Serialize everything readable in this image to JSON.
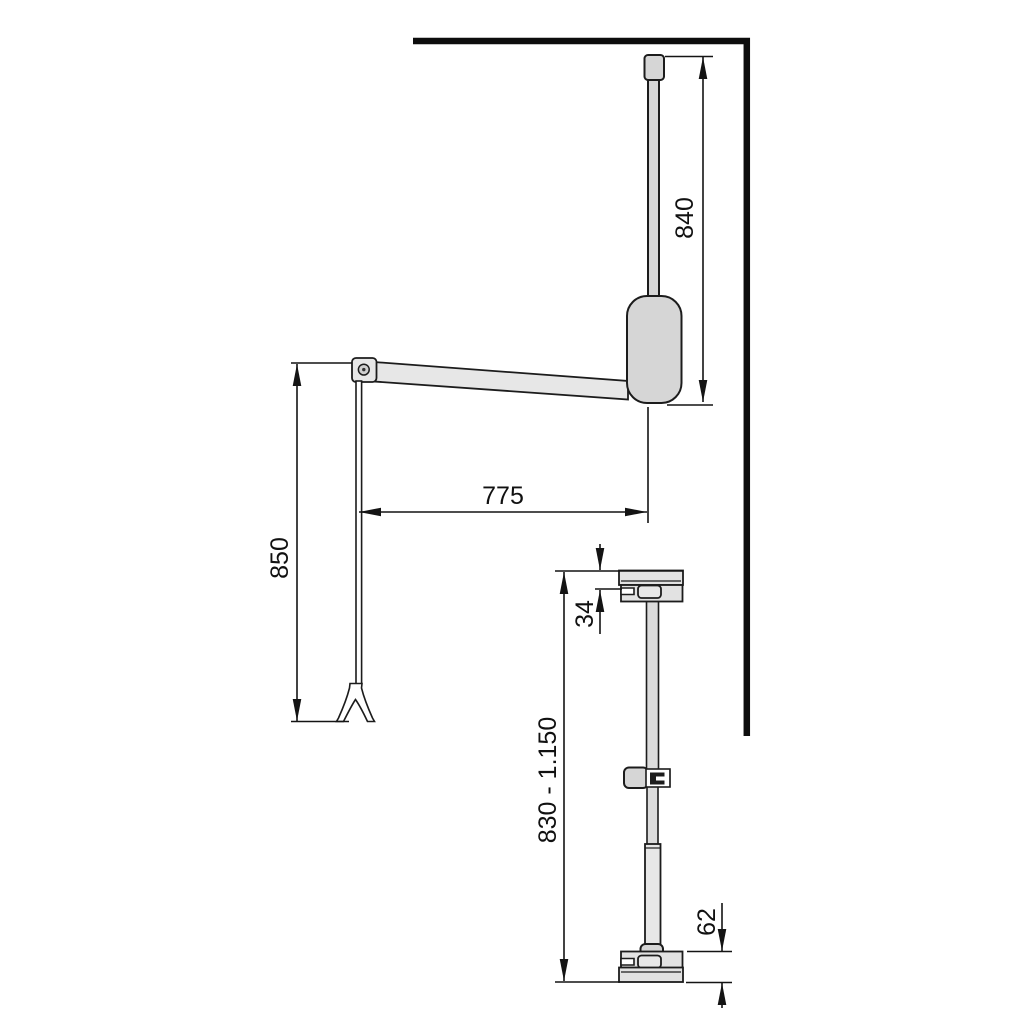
{
  "drawing": {
    "front_view": {
      "dimensions": {
        "rod_height": "840",
        "arm_reach": "775",
        "arm_drop": "850"
      }
    },
    "side_view": {
      "dimensions": {
        "top_bracket_height": "34",
        "adjustable_height_range": "830 - 1.150",
        "bottom_bracket_height": "62"
      }
    },
    "colors": {
      "line": "#1c1c1c",
      "wall_line": "#0d0d0d",
      "part_fill": "#d6d6d6",
      "part_fill_light": "#e7e7e7",
      "bracket_fill": "#e2e2e2",
      "background": "#ffffff"
    }
  }
}
